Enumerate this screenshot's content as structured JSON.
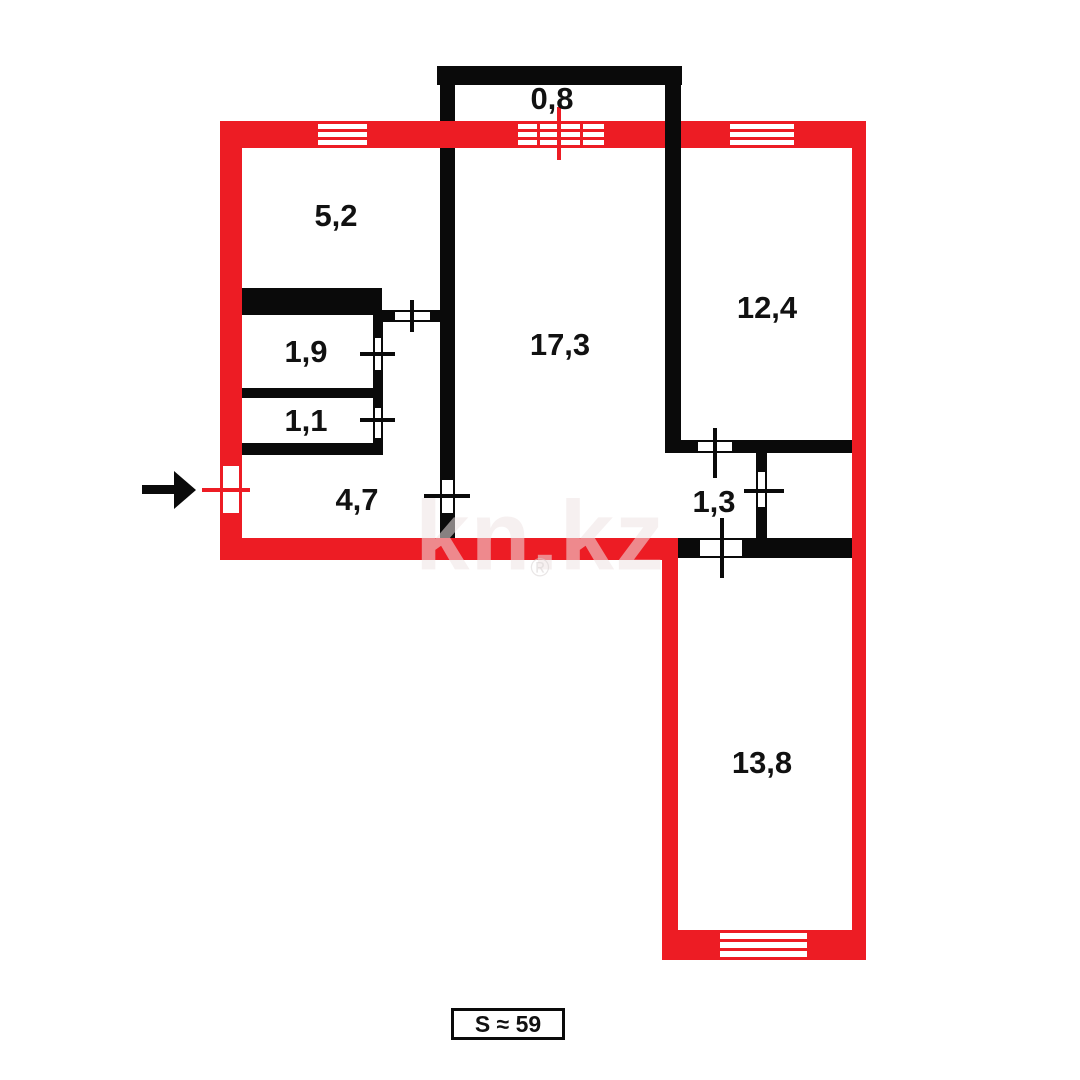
{
  "watermark": {
    "text": "kn.kz",
    "registered_mark": "®"
  },
  "total_area_label": "S ≈ 59",
  "colors": {
    "exterior_wall": "#ed1c24",
    "interior_wall": "#0a0a0a",
    "label_text": "#111111",
    "watermark": "#f3e9e9"
  },
  "room_areas": {
    "balcony": "0,8",
    "kitchen": "5,2",
    "bathroom": "1,9",
    "toilet": "1,1",
    "hallway": "4,7",
    "living_room": "17,3",
    "bedroom_right": "12,4",
    "corridor": "1,3",
    "bedroom_bottom": "13,8"
  }
}
